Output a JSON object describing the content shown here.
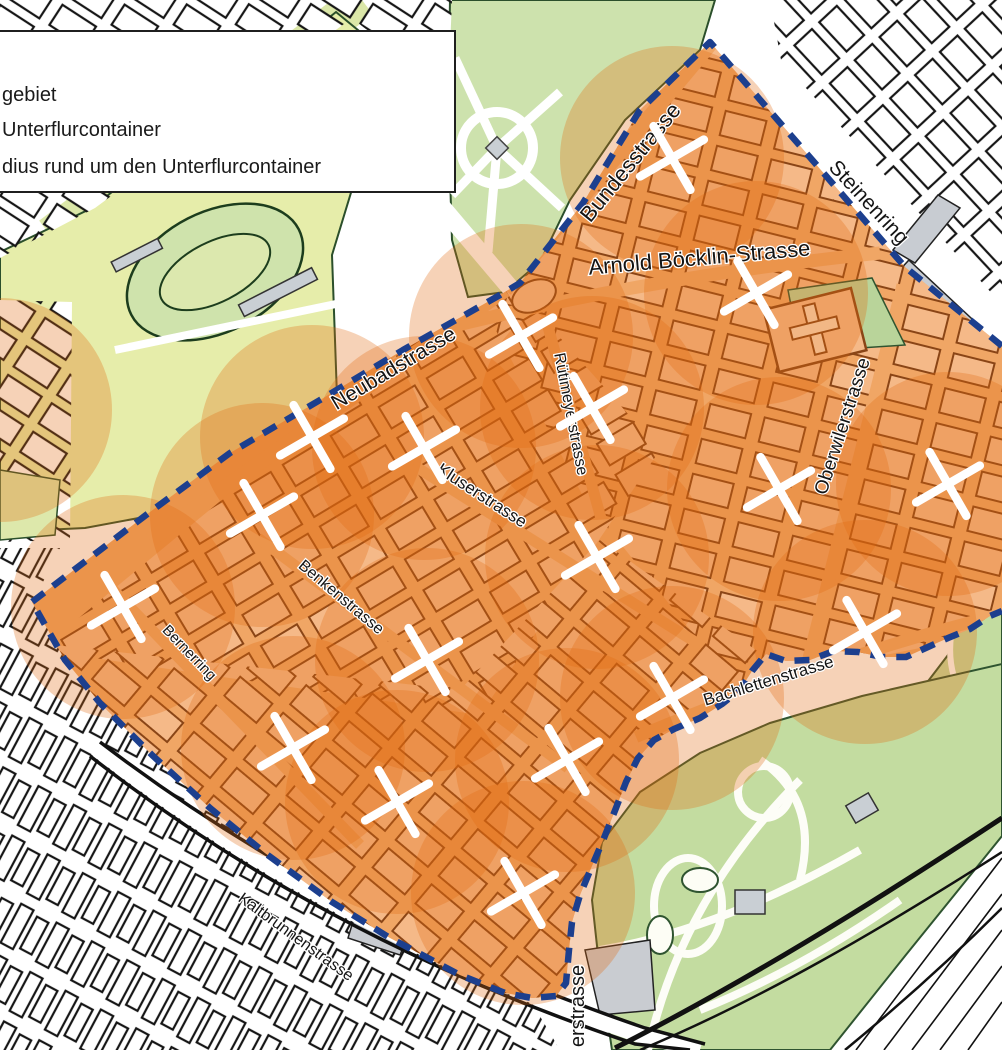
{
  "legend": {
    "items": [
      {
        "label": "gebiet"
      },
      {
        "label": "Unterflurcontainer"
      },
      {
        "label": "dius rund um den Unterflurcontainer"
      }
    ]
  },
  "map": {
    "colors": {
      "coverage_fill": "#e26a10",
      "coverage_opacity": 0.3,
      "boundary": "#1c3f8e",
      "mark": "#ffffff",
      "label_color": "#141414"
    },
    "street_labels": [
      {
        "text": "Bundesstrasse",
        "x": 636,
        "y": 167,
        "rot": -51,
        "size": 22
      },
      {
        "text": "Steinenring",
        "x": 864,
        "y": 207,
        "rot": 47,
        "size": 21
      },
      {
        "text": "Arnold Böcklin-Strasse",
        "x": 700,
        "y": 265,
        "rot": -5,
        "size": 22
      },
      {
        "text": "Neubadstrasse",
        "x": 397,
        "y": 374,
        "rot": -31,
        "size": 21
      },
      {
        "text": "Rütimeyerstrasse",
        "x": 566,
        "y": 415,
        "rot": 79,
        "size": 16
      },
      {
        "text": "Kluserstrasse",
        "x": 479,
        "y": 500,
        "rot": 33,
        "size": 17
      },
      {
        "text": "Oberwilerstrasse",
        "x": 848,
        "y": 428,
        "rot": -72,
        "size": 19
      },
      {
        "text": "Benkenstrasse",
        "x": 338,
        "y": 601,
        "rot": 40,
        "size": 16
      },
      {
        "text": "Bernerring",
        "x": 186,
        "y": 656,
        "rot": 46,
        "size": 15
      },
      {
        "text": "Bachlettenstrasse",
        "x": 770,
        "y": 686,
        "rot": -17,
        "size": 17
      },
      {
        "text": "Kaltbrunnenstrasse",
        "x": 293,
        "y": 941,
        "rot": 36,
        "size": 16
      },
      {
        "text": "erstrasse",
        "x": 584,
        "y": 1006,
        "rot": -90,
        "size": 20
      }
    ],
    "container_marks": [
      [
        672,
        158
      ],
      [
        756,
        293
      ],
      [
        521,
        336
      ],
      [
        592,
        408
      ],
      [
        312,
        437
      ],
      [
        424,
        448
      ],
      [
        262,
        515
      ],
      [
        123,
        607
      ],
      [
        948,
        484
      ],
      [
        779,
        489
      ],
      [
        597,
        557
      ],
      [
        865,
        632
      ],
      [
        427,
        660
      ],
      [
        293,
        748
      ],
      [
        567,
        760
      ],
      [
        672,
        698
      ],
      [
        523,
        893
      ],
      [
        397,
        802
      ]
    ],
    "coverage_circles": {
      "radius_px": 112,
      "centers": [
        [
          672,
          158
        ],
        [
          756,
          293
        ],
        [
          521,
          336
        ],
        [
          592,
          408
        ],
        [
          312,
          437
        ],
        [
          424,
          448
        ],
        [
          262,
          515
        ],
        [
          123,
          607
        ],
        [
          948,
          484
        ],
        [
          779,
          489
        ],
        [
          597,
          557
        ],
        [
          865,
          632
        ],
        [
          427,
          660
        ],
        [
          293,
          748
        ],
        [
          567,
          760
        ],
        [
          672,
          698
        ],
        [
          523,
          893
        ],
        [
          397,
          802
        ],
        [
          0,
          410
        ]
      ]
    },
    "boundary": {
      "path": "M 1002,346 L 905,267 L 710,42 L 640,110 L 583,203 L 520,283 L 500,295 L 403,350 L 320,400 L 230,453 L 150,512 L 32,602 L 65,660 L 100,703 L 152,755 L 210,808 L 265,853 L 332,902 L 390,938 L 460,975 L 505,993 L 532,998 L 556,996 L 566,983 L 569,950 L 572,922 L 580,895 L 592,866 L 604,838 L 616,808 L 626,782 L 638,758 L 654,740 L 674,729 L 700,718 L 722,704 L 740,690 L 752,671 L 766,654 L 786,661 L 810,660 L 834,651 L 858,652 L 882,657 L 906,657 L 928,647 L 948,638 L 970,629 L 990,616 L 1002,611"
    }
  }
}
